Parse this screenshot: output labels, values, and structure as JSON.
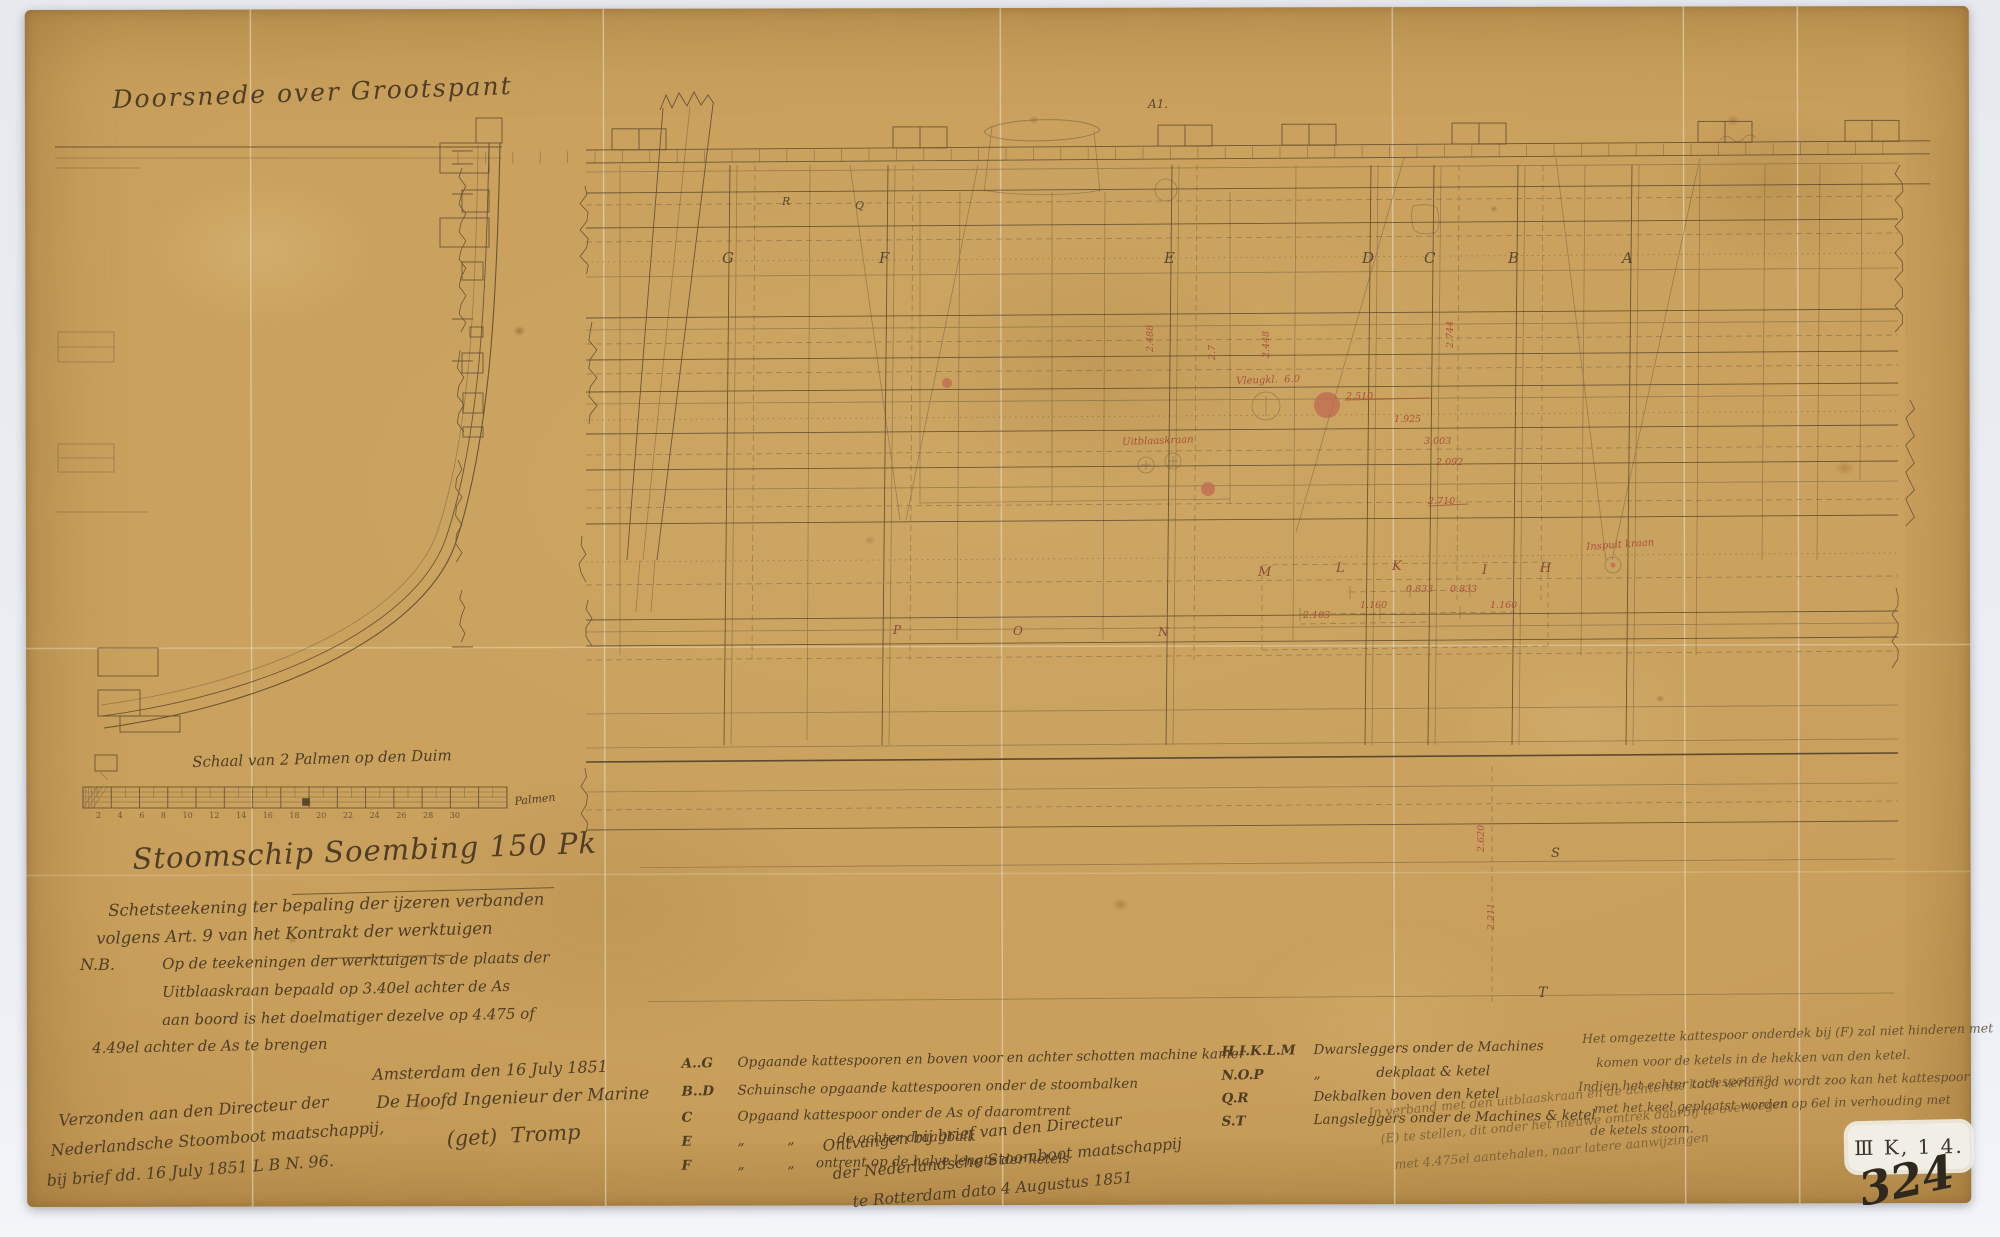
{
  "sheet": {
    "mark": "A1.",
    "stamp_code": "Ⅲ K, 1 4.",
    "stamp_number": "324"
  },
  "cross_section": {
    "title": "Doorsnede over Grootspant"
  },
  "scale_bar": {
    "title": "Schaal van 2 Palmen op den Duim",
    "ticks": "2 4 6 8 10 12 14 16 18 20 22 24 26 28 30",
    "unit": "Palmen"
  },
  "title_block": {
    "title": "Stoomschip Soembing 150 Pk",
    "subtitle1": "Schetsteekening ter bepaling der ijzeren verbanden",
    "subtitle2": "volgens Art. 9 van het Kontrakt der werktuigen",
    "nb_label": "N.B.",
    "nb_lines": [
      "Op de teekeningen der werktuigen is de plaats der",
      "Uitblaaskraan bepaald op 3.40el achter de As",
      "aan boord is het doelmatiger dezelve op 4.475 of",
      "4.49el achter de As te brengen"
    ]
  },
  "correspondence": {
    "sent": [
      "Verzonden aan den Directeur der",
      "Nederlandsche Stoomboot maatschappij,",
      "bij brief dd. 16 July 1851 L B N. 96."
    ],
    "dateline": "Amsterdam den 16 July 1851",
    "signer_title": "De Hoofd Ingenieur der Marine",
    "signature": "(get)  Tromp",
    "received": [
      "Ontvangen bij brief van den Directeur",
      "der Nederlandsche Stoomboot maatschappij",
      "te Rotterdam dato 4 Augustus 1851"
    ]
  },
  "legend_left": {
    "rows": [
      {
        "key": "A..G",
        "desc": "Opgaande kattespooren en boven voor en achter schotten machine kamer"
      },
      {
        "key": "B..D",
        "desc": "Schuinsche opgaande kattespooren onder de stoombalken"
      },
      {
        "key": "C",
        "desc": "Opgaand kattespoor onder de As of daaromtrent"
      },
      {
        "key": "E",
        "desc": "„          „          de achter draagbalk"
      },
      {
        "key": "F",
        "desc": "„          „     ontrent op de halve lengte der ketels"
      }
    ]
  },
  "legend_right": {
    "rows": [
      {
        "key": "H.I.K.L.M",
        "desc": "Dwarsleggers onder de Machines"
      },
      {
        "key": "N.O.P",
        "desc": "„             dekplaat & ketel"
      },
      {
        "key": "Q.R",
        "desc": "Dekbalken boven den ketel"
      },
      {
        "key": "S.T",
        "desc": "Langsleggers onder de Machines & ketel"
      }
    ]
  },
  "notes_right": {
    "para1": [
      "Het omgezette kattespoor onderdek bij (F) zal niet hinderen met",
      "komen voor de ketels in de hekken van den ketel.",
      "Indien het echter toch verlangd wordt zoo kan het kattespoor",
      "met het keel geplaatst worden op 6el in verhouding met",
      "de ketels stoom."
    ],
    "para2": [
      "In verband met den uitblaaskraan en de achterste kattespooren",
      "(E) te stellen, dit onder het nieuwe omtrek daarbij te overwegen",
      "met 4.475el aantehalen, naar latere aanwijzingen"
    ]
  },
  "drawing": {
    "frame_letters": [
      "G",
      "F",
      "E",
      "D",
      "C",
      "B",
      "A"
    ],
    "deck_letters": [
      "R",
      "Q"
    ],
    "legger_letters": [
      "M",
      "L",
      "K",
      "I",
      "H"
    ],
    "bottom_letters": [
      "P",
      "O",
      "N"
    ],
    "side_letters": [
      "S",
      "T"
    ],
    "red_labels": {
      "valve": "Vleugkl.  6.0",
      "blowoff": "Uitblaaskraan",
      "injection": "Inspuit kraan"
    },
    "red_dims_h": [
      "2.510",
      "1.925",
      "3.003",
      "2.092",
      "2.710",
      "0.833",
      "0.833",
      "1.160",
      "1.160",
      "2.103"
    ],
    "red_dims_v": [
      "2.488",
      "2.7",
      "2.448",
      "2.744",
      "2.620",
      "2.211"
    ]
  },
  "colors": {
    "paper": "#c89f5b",
    "ink": "#54422a",
    "red": "#a8523a"
  }
}
